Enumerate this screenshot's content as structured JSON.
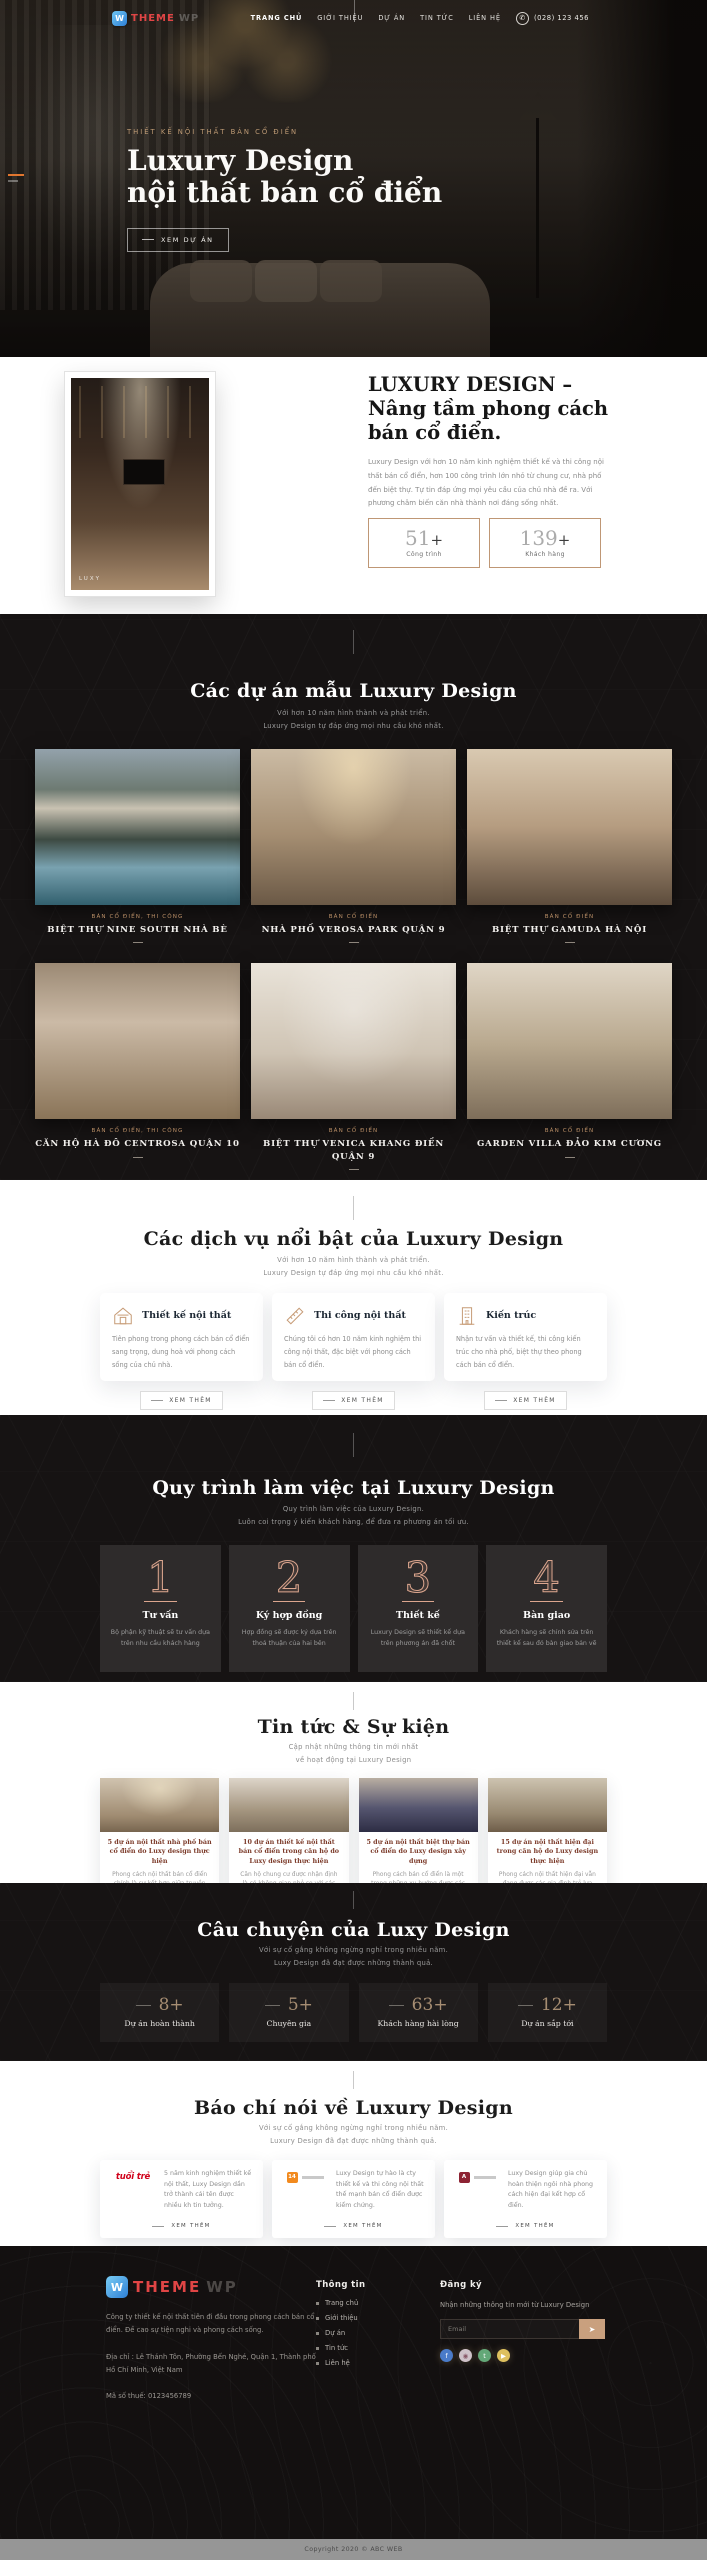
{
  "header": {
    "brand": "THEME",
    "brand_suffix": "WP",
    "logo_glyph": "W",
    "nav": [
      {
        "label": "TRANG CHỦ"
      },
      {
        "label": "GIỚI THIỆU"
      },
      {
        "label": "DỰ ÁN"
      },
      {
        "label": "TIN TỨC"
      },
      {
        "label": "LIÊN HỆ"
      }
    ],
    "phone": "(028) 123 456"
  },
  "hero": {
    "eyebrow": "THIẾT KẾ NỘI THẤT BÁN CỔ ĐIỂN",
    "title_line1": "Luxury Design",
    "title_line2": "nội thất bán cổ điển",
    "cta": "XEM DỰ ÁN"
  },
  "about": {
    "heading": "LUXURY DESIGN – Nâng tầm phong cách bán cổ điển.",
    "body": "Luxury Design với hơn 10 năm kinh nghiệm thiết kế và thi công nội thất bán cổ điển, hơn 100 công trình lớn nhỏ từ chung cư, nhà phố đến biệt thự. Tự tin đáp ứng mọi yêu cầu của chủ nhà đề ra. Với phương châm biến căn nhà thành nơi đáng sống nhất.",
    "more": "XEM THÊM",
    "watermark": "LUXY",
    "stats": [
      {
        "number": "51",
        "suffix": "+",
        "label": "Công trình"
      },
      {
        "number": "139",
        "suffix": "+",
        "label": "Khách hàng"
      }
    ]
  },
  "projects": {
    "heading": "Các dự án mẫu Luxury Design",
    "sub1": "Với hơn 10 năm hình thành và phát triển.",
    "sub2": "Luxury Design tự đáp ứng mọi nhu cầu khó nhất.",
    "items": [
      {
        "category": "BÁN CỔ ĐIỂN, THI CÔNG",
        "title": "BIỆT THỰ NINE SOUTH NHÀ BÈ"
      },
      {
        "category": "BÁN CỔ ĐIỂN",
        "title": "NHÀ PHỐ VEROSA PARK QUẬN 9"
      },
      {
        "category": "BÁN CỔ ĐIỂN",
        "title": "BIỆT THỰ GAMUDA HÀ NỘI"
      },
      {
        "category": "BÁN CỔ ĐIỂN, THI CÔNG",
        "title": "CĂN HỘ HÀ ĐÔ CENTROSA QUẬN 10"
      },
      {
        "category": "BÁN CỔ ĐIỂN",
        "title": "BIỆT THỰ VENICA KHANG ĐIỀN QUẬN 9"
      },
      {
        "category": "BÁN CỔ ĐIỂN",
        "title": "GARDEN VILLA ĐẢO KIM CƯƠNG"
      }
    ]
  },
  "services": {
    "heading": "Các dịch vụ nổi bật của Luxury Design",
    "sub1": "Với hơn 10 năm hình thành và phát triển.",
    "sub2": "Luxury Design tự đáp ứng mọi nhu cầu khó nhất.",
    "more": "XEM THÊM",
    "items": [
      {
        "title": "Thiết kế nội thất",
        "text": "Tiên phong trong phong cách bán cổ điển sang trọng, dung hoà với phong cách sống của chủ nhà."
      },
      {
        "title": "Thi công nội thất",
        "text": "Chúng tôi có hơn 10 năm kinh nghiệm thi công nội thất, đặc biệt với phong cách bán cổ điển."
      },
      {
        "title": "Kiến trúc",
        "text": "Nhận tư vấn và thiết kế, thi công kiến trúc cho nhà phố, biệt thự theo phong cách bán cổ điển."
      }
    ]
  },
  "process": {
    "heading": "Quy trình làm việc tại Luxury Design",
    "sub1": "Quy trình làm việc của Luxury Design.",
    "sub2": "Luôn coi trọng ý kiến khách hàng, để đưa ra phương án tối ưu.",
    "steps": [
      {
        "number": "1",
        "title": "Tư vấn",
        "text": "Bộ phận kỹ thuật sẽ tư vấn dựa trên nhu cầu khách hàng"
      },
      {
        "number": "2",
        "title": "Ký hợp đồng",
        "text": "Hợp đồng sẽ được ký dựa trên thoả thuận của hai bên"
      },
      {
        "number": "3",
        "title": "Thiết kế",
        "text": "Luxury Design sẽ thiết kế dựa trên phương án đã chốt"
      },
      {
        "number": "4",
        "title": "Bàn giao",
        "text": "Khách hàng sẽ chỉnh sửa trên thiết kế sau đó bàn giao bản vẽ"
      }
    ]
  },
  "news": {
    "heading": "Tin tức & Sự kiện",
    "sub1": "Cập nhật những thông tin mới nhất",
    "sub2": "về hoạt động tại Luxury Design",
    "more": "XEM THÊM",
    "items": [
      {
        "title": "5 dự án nội thất nhà phố bán cổ điển do Luxy design thực hiện",
        "text": "Phong cách nội thất bán cổ điển chính là sự kết hợp giữa truyền thống"
      },
      {
        "title": "10 dự án thiết kế nội thất bán cổ điển trong căn hộ do Luxy design thực hiện",
        "text": "Căn hộ chung cư được nhận định là có không gian nhỏ so với các"
      },
      {
        "title": "5 dự án nội thất biệt thự bán cổ điển do Luxy design xây dựng",
        "text": "Phong cách bán cổ điển là một trong những xu hướng được các gia chủ"
      },
      {
        "title": "15 dự án nội thất hiện đại trong căn hộ do Luxy design thực hiện",
        "text": "Phong cách nội thất hiện đại vẫn đang được các gia đình trẻ lựa chọn"
      }
    ]
  },
  "story": {
    "heading": "Câu chuyện của Luxy Design",
    "sub1": "Với sự cố gắng không ngừng nghỉ trong nhiều năm.",
    "sub2": "Luxy Design đã đạt được những thành quả.",
    "stats": [
      {
        "number": "8",
        "suffix": "+",
        "label": "Dự án hoàn thành"
      },
      {
        "number": "5",
        "suffix": "+",
        "label": "Chuyên gia"
      },
      {
        "number": "63",
        "suffix": "+",
        "label": "Khách hàng hài lòng"
      },
      {
        "number": "12",
        "suffix": "+",
        "label": "Dự án sắp tới"
      }
    ]
  },
  "press": {
    "heading": "Báo chí nói về Luxury Design",
    "sub1": "Với sự cố gắng không ngừng nghỉ trong nhiều năm.",
    "sub2": "Luxury Design đã đạt được những thành quả.",
    "more": "XEM THÊM",
    "items": [
      {
        "logo_text": "tuổi trẻ",
        "text": "5 năm kinh nghiệm thiết kế nội thất, Luxy Design dần trở thành cái tên được nhiều kh tin tưởng."
      },
      {
        "logo_text": "14",
        "text": "Luxy Design tự hào là cty thiết kế và thi công nội thất thế mạnh bán cổ điển được kiểm chứng."
      },
      {
        "logo_text": "A",
        "text": "Luxy Design giúp gia chủ hoàn thiện ngôi nhà phong cách hiện đại kết hợp cổ điển."
      }
    ]
  },
  "footer": {
    "brand": "THEME",
    "brand_suffix": "WP",
    "logo_glyph": "W",
    "about": "Công ty thiết kế nội thất tiên đi đầu trong phong cách bán cổ điển. Đề cao sự tiện nghi và phong cách sống.",
    "address": "Địa chỉ : Lê Thánh Tôn, Phường Bến Nghé, Quận 1, Thành phố Hồ Chí Minh, Việt Nam",
    "tax": "Mã số thuế: 0123456789",
    "info_title": "Thông tin",
    "info_links": [
      "Trang chủ",
      "Giới thiệu",
      "Dự án",
      "Tin tức",
      "Liên hệ"
    ],
    "subscribe_title": "Đăng ký",
    "subscribe_text": "Nhận những thông tin mới từ Luxury Design",
    "email_placeholder": "Email",
    "copyright": "Copyright 2020 © ABC WEB"
  }
}
